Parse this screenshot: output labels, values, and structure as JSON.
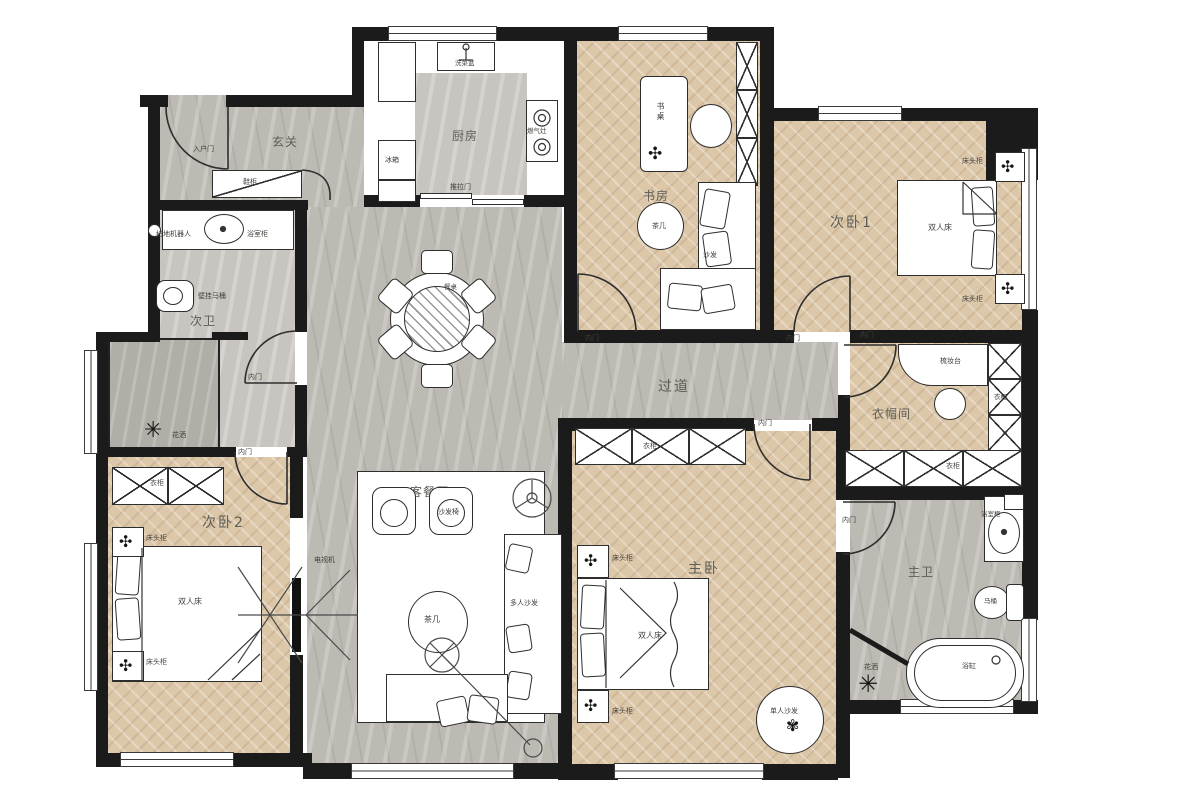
{
  "rooms": {
    "foyer": "玄关",
    "kitchen": "厨房",
    "study": "书房",
    "bedroom1": "次卧1",
    "bath2": "次卫",
    "corridor": "过道",
    "closet": "衣帽间",
    "living": "客餐厅",
    "bedroom2": "次卧2",
    "master": "主卧",
    "bath1": "主卫"
  },
  "items": {
    "entry_door": "入户门",
    "shoe_cabinet": "鞋柜",
    "robot_vacuum": "扫地机器人",
    "vanity": "浴室柜",
    "wall_toilet": "壁挂马桶",
    "shower": "花洒",
    "fridge": "冰箱",
    "gas_stove": "燃气灶",
    "kitchen_sink": "洗菜盆",
    "sliding_door": "推拉门",
    "desk": "书桌",
    "tea_table": "茶几",
    "sofa": "沙发",
    "inner_door": "内门",
    "double_bed": "双人床",
    "nightstand": "床头柜",
    "dining_table": "餐桌",
    "dresser": "梳妆台",
    "wardrobe": "衣柜",
    "armchair": "沙发椅",
    "sectional_sofa": "多人沙发",
    "tv": "电视机",
    "single_sofa": "单人沙发",
    "toilet": "马桶",
    "bathtub": "浴缸"
  },
  "colors": {
    "wall": "#1b1b1b",
    "wood_floor": "#dcc7a9",
    "marble_floor": "#bdb9b3",
    "line": "#2e2e2e"
  }
}
